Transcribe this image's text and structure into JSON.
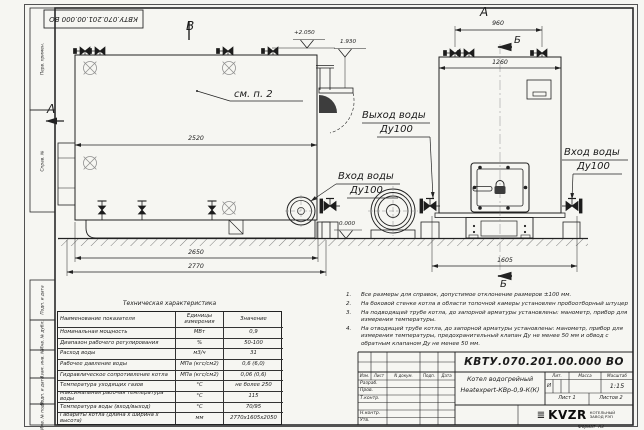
{
  "corner_stamp": "КВТУ.070.201.00.000 ВО",
  "margin_labels": [
    "Перв. примен.",
    "Справ. №",
    "Подп. и дата",
    "Инв. № дубл.",
    "Взам. инв. №",
    "Подп. и дата",
    "Инв. № подл."
  ],
  "views": {
    "view_b": "В",
    "view_a": "А",
    "view_a_arrow": "А",
    "section_b_top": "Б",
    "section_b_bottom": "Б",
    "see_note": "см. п. 2"
  },
  "dims": {
    "d2520": "2520",
    "d2650": "2650",
    "d2770": "2770",
    "d960": "960",
    "d1260": "1260",
    "d1605": "1605"
  },
  "elevations": {
    "top": "+2.050",
    "outlet": "1.930",
    "ground": "0.000"
  },
  "pipe_labels": {
    "outlet": "Выход воды",
    "outlet_dn": "Ду100",
    "inlet_left": "Вход воды",
    "inlet_left_dn": "Ду100",
    "inlet_right": "Вход воды",
    "inlet_right_dn": "Ду100"
  },
  "tech_table": {
    "title": "Техническая характеристика",
    "headers": [
      "Наименование показателя",
      "Единицы измерения",
      "Значение"
    ],
    "rows": [
      [
        "Номинальная мощность",
        "МВт",
        "0,9"
      ],
      [
        "Диапазон рабочего регулирования",
        "%",
        "50-100"
      ],
      [
        "Расход воды",
        "м3/ч",
        "31"
      ],
      [
        "Рабочее давление воды",
        "МПа (кгс/см2)",
        "0,6 (6,0)"
      ],
      [
        "Гидравлическое сопротивление котла",
        "МПа (кгс/см2)",
        "0,06 (0,6)"
      ],
      [
        "Температура уходящих газов",
        "°С",
        "не более 250"
      ],
      [
        "Максимальная рабочая температура воды",
        "°С",
        "115"
      ],
      [
        "Температура воды (вход/выход)",
        "°С",
        "70/95"
      ],
      [
        "Габариты котла (длина х ширина х высота)",
        "мм",
        "2770х1605х2050"
      ]
    ]
  },
  "notes": {
    "items": [
      {
        "n": "1.",
        "t": "Все размеры для справок, допустимое отклонение размеров ±100 мм."
      },
      {
        "n": "2.",
        "t": "На боковой стенке котла в области топочной камеры установлен пробоотборный штуцер"
      },
      {
        "n": "3.",
        "t": "На подводящей трубе котла, до запорной арматуры установлены: манометр, прибор для измерения температуры."
      },
      {
        "n": "4.",
        "t": "На отводящей трубе котла, до запорной арматуры установлены: манометр, прибор для измерения температуры, предохранительный клапан Ду не менее 50 мм и обвод с обратным клапаном Ду не менее 50 мм."
      }
    ]
  },
  "title_block": {
    "number": "КВТУ.070.201.00.000  ВО",
    "name1": "Котел водогрейный",
    "name2": "Heatexpert-КВр-0,9-К(К)",
    "sign_cols": [
      "Изм.",
      "Лист",
      "N докум.",
      "Подп.",
      "Дата"
    ],
    "sign_rows": [
      "Разраб.",
      "Пров.",
      "Т.контр.",
      "",
      "Н.контр.",
      "Утв."
    ],
    "lit_label": "Лит.",
    "mass_label": "Масса",
    "scale_label": "Масштаб",
    "lit_value": "И",
    "scale_value": "1:15",
    "sheet_label": "Лист",
    "sheet_value": "1",
    "sheets_label": "Листов",
    "sheets_value": "2",
    "logo_text": "KVZR",
    "logo_sub1": "КОТЕЛЬНЫЙ",
    "logo_sub2": "ЗАВОД РЭП",
    "format_label": "Формат",
    "format_value": "А3"
  }
}
